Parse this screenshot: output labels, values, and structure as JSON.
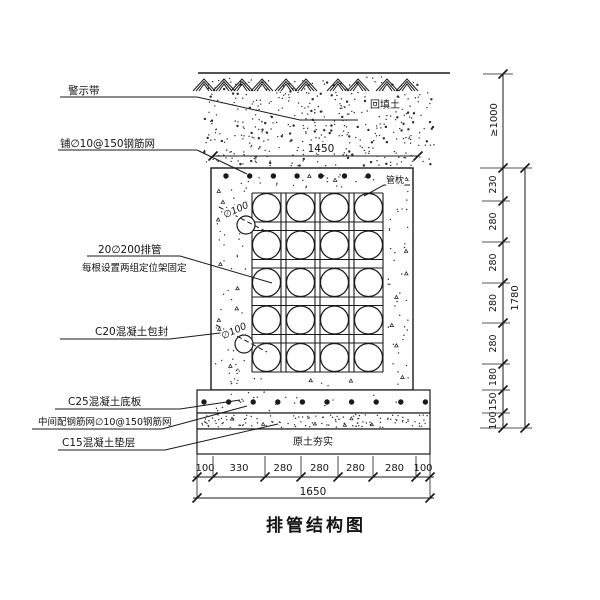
{
  "title": "排管结构图",
  "callouts": {
    "warning_tape": "警示带",
    "top_mesh": "铺∅10@150钢筋网",
    "pipes_line1": "20∅200排管",
    "pipes_line2": "每根设置两组定位架固定",
    "encasement": "C20混凝土包封",
    "base_slab": "C25混凝土底板",
    "mid_mesh": "中间配钢筋网∅10@150钢筋网",
    "cushion": "C15混凝土垫层",
    "backfill": "回填土",
    "pipe_pillow": "管枕",
    "compacted_soil": "原土夯实",
    "small_pipe_dia_1": "∅100",
    "small_pipe_dia_2": "∅100"
  },
  "dimensions": {
    "top_width": "1450",
    "bottom_segments": [
      "100",
      "330",
      "280",
      "280",
      "280",
      "280",
      "100"
    ],
    "bottom_total": "1650",
    "right_cover": "≥1000",
    "right_segments": [
      "230",
      "280",
      "280",
      "280",
      "280",
      "180",
      "150",
      "100"
    ],
    "right_total": "1780"
  },
  "pipe_grid": {
    "rows": 5,
    "cols": 4
  },
  "colors": {
    "ink": "#1a1a1a",
    "paper": "#ffffff"
  }
}
